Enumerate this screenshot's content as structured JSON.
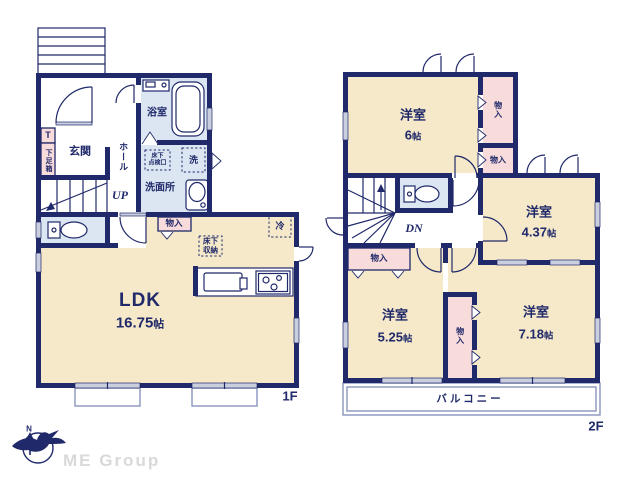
{
  "palette": {
    "wall": "#20296a",
    "cream": "#f5e9c9",
    "blue": "#dbe6f2",
    "pink": "#f8dbdb",
    "wingray": "#c9cfdf",
    "terr": "#8a94bd",
    "brand": "#d9d9d9"
  },
  "f1": {
    "tag": "1F",
    "entrance": "玄関",
    "t_box": "T",
    "shoe_box": "下足箱",
    "hall": "ホール",
    "up": "UP",
    "bath": "浴室",
    "washroom": "洗面所",
    "washer": "洗",
    "hatch_l1": "床下",
    "hatch_l2": "点検口",
    "closet": "物入",
    "underfloor_l1": "床下",
    "underfloor_l2": "収納",
    "fridge": "冷",
    "ldk_name": "LDK",
    "ldk_area": "16.75",
    "area_unit": "帖"
  },
  "f2": {
    "tag": "2F",
    "r6_name": "洋室",
    "r6_area": "6",
    "r437_name": "洋室",
    "r437_area": "4.37",
    "r525_name": "洋室",
    "r525_area": "5.25",
    "r718_name": "洋室",
    "r718_area": "7.18",
    "area_unit": "帖",
    "closet_top": "物入",
    "closet_mid": "物入",
    "closet_left": "物入",
    "closet_center": "物入",
    "dn": "DN",
    "balcony": "バルコニー"
  },
  "footer": {
    "brand": "ME Group",
    "north": "N"
  }
}
